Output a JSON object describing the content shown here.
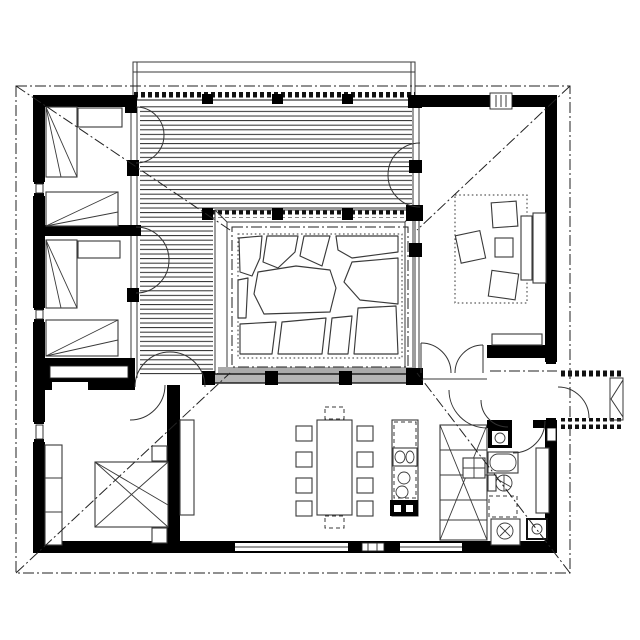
{
  "plan": {
    "type": "architectural-floor-plan",
    "colors": {
      "bg": "#ffffff",
      "ink": "#000000",
      "line": "#3a3a3a",
      "muted": "#8a8a8a",
      "glass": "#b5b5b5"
    },
    "rooms": [
      {
        "name": "bedroom-1"
      },
      {
        "name": "bedroom-2"
      },
      {
        "name": "master-bedroom"
      },
      {
        "name": "hall"
      },
      {
        "name": "living-room"
      },
      {
        "name": "dining-kitchen"
      },
      {
        "name": "bathroom"
      },
      {
        "name": "entry"
      },
      {
        "name": "entry-porch"
      },
      {
        "name": "wood-deck-courtyard"
      },
      {
        "name": "stone-patio"
      }
    ],
    "furniture": [
      "single-bed",
      "single-bed",
      "desk",
      "single-bed",
      "single-bed",
      "desk",
      "double-bed",
      "nightstand",
      "nightstand",
      "wardrobe",
      "dining-table",
      "dining-chairs",
      "kitchen-island",
      "tall-cabinets",
      "sofa",
      "armchair",
      "armchair",
      "armchair",
      "coffee-table",
      "rug",
      "washbasin",
      "bathtub",
      "toilet",
      "shower",
      "washing-machine",
      "bench"
    ]
  }
}
